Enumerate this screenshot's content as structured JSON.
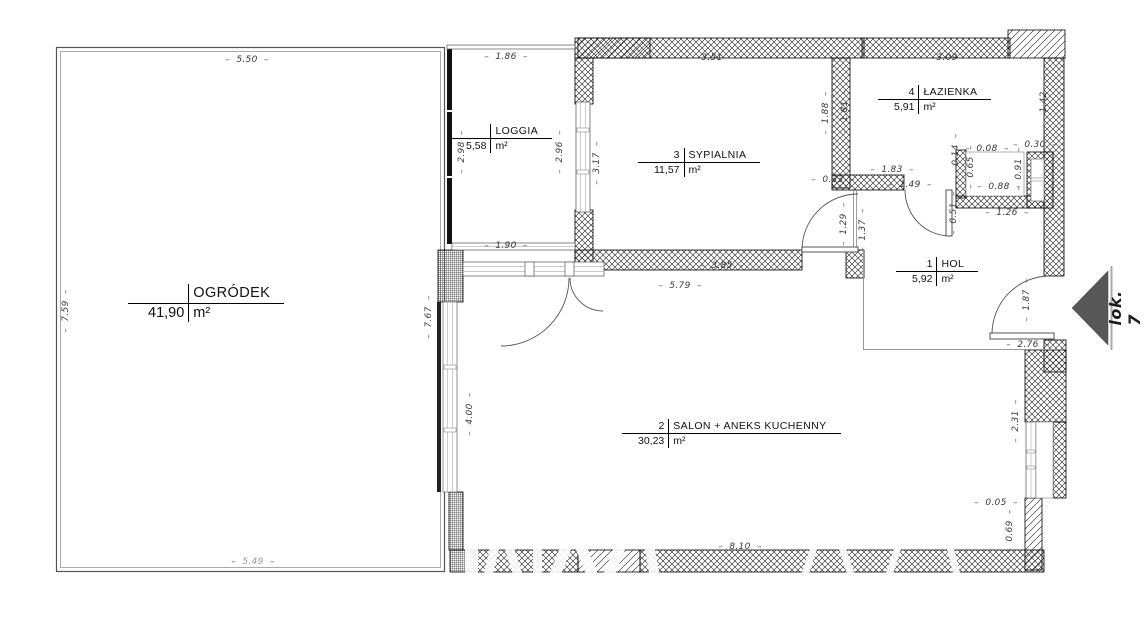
{
  "plan": {
    "type": "floor-plan",
    "background": "#ffffff"
  },
  "rooms": [
    {
      "num": "1",
      "name": "HOL",
      "area": "5,92",
      "unit": "m²"
    },
    {
      "num": "2",
      "name": "SALON + ANEKS KUCHENNY",
      "area": "30,23",
      "unit": "m²"
    },
    {
      "num": "3",
      "name": "SYPIALNIA",
      "area": "11,57",
      "unit": "m²"
    },
    {
      "num": "4",
      "name": "ŁAZIENKA",
      "area": "5,91",
      "unit": "m²"
    },
    {
      "num": "",
      "name": "LOGGIA",
      "area": "5,58",
      "unit": "m²"
    },
    {
      "num": "",
      "name": "OGRÓDEK",
      "area": "41,90",
      "unit": "m²"
    }
  ],
  "dims": [
    "5.50",
    "7.59",
    "5.49",
    "1.86",
    "2.98",
    "2.96",
    "1.90",
    "3.51",
    "3.17",
    "1.88",
    "1.81",
    "0.33",
    "1.29",
    "1.37",
    "3.85",
    "5.79",
    "3.09",
    "1.42",
    "1.83",
    "1.49",
    "0.14",
    "0.08",
    "0.30",
    "0.65",
    "0.91",
    "0.51",
    "0.88",
    "1.26",
    "1.87",
    "2.76",
    "7.67",
    "4.00",
    "2.31",
    "0.05",
    "0.69",
    "8.10"
  ],
  "entrance": {
    "label": "lok. 7",
    "arrow_direction": "left",
    "arrow_color": "#575757"
  },
  "colors": {
    "wall_hatch": "#1a1a1a",
    "dim_text": "#3a3a3a",
    "room_text": "#111111",
    "fence": "#555555"
  }
}
